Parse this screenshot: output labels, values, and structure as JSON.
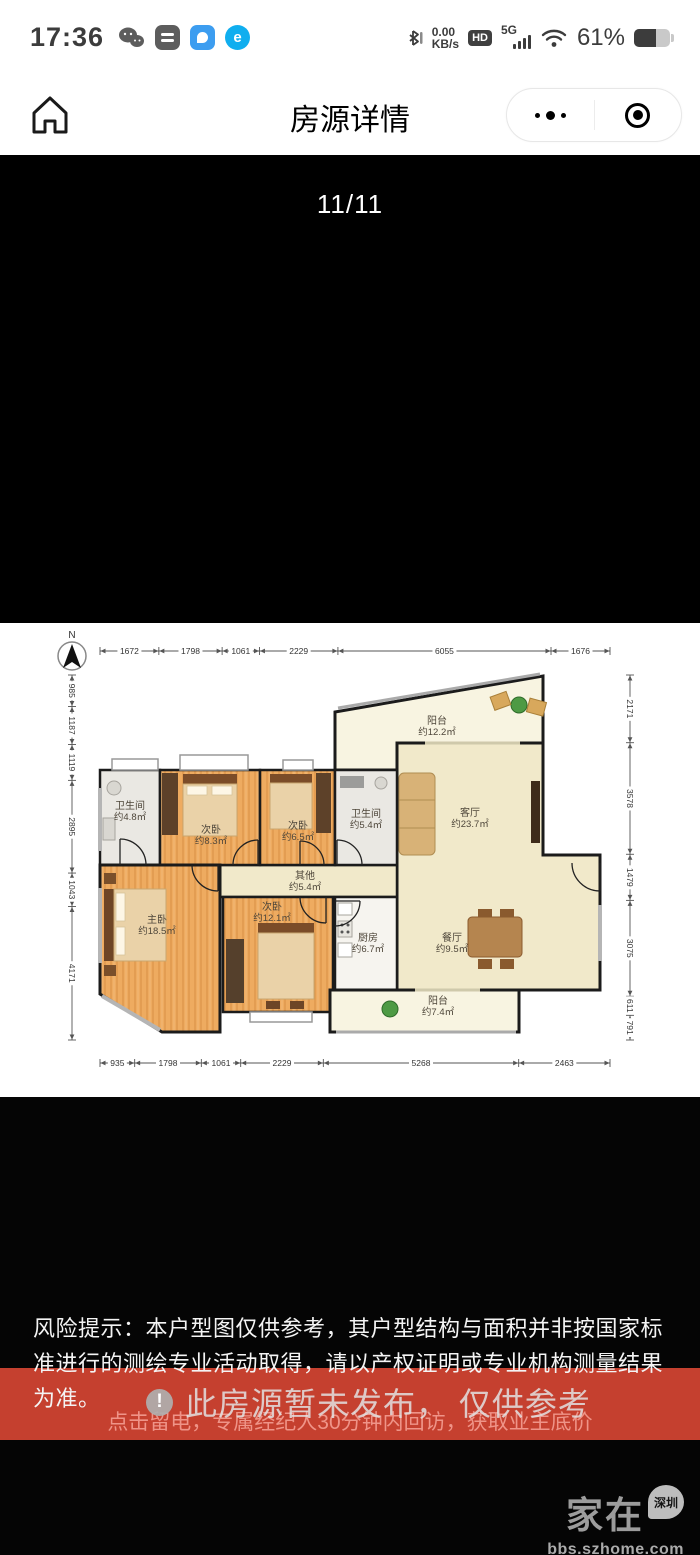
{
  "status_bar": {
    "time": "17:36",
    "speed_top": "0.00",
    "speed_bottom": "KB/s",
    "hd_label": "HD",
    "net_label": "5G",
    "battery_percent": "61%",
    "e_icon_label": "e"
  },
  "nav": {
    "title": "房源详情"
  },
  "gallery": {
    "counter": "11/11"
  },
  "floorplan": {
    "compass_label": "N",
    "dims": {
      "top": [
        1672,
        1798,
        1061,
        2229,
        6055,
        1676
      ],
      "bottom": [
        935,
        1798,
        1061,
        2229,
        5268,
        2463
      ],
      "left": [
        985,
        1187,
        1119,
        2895,
        1043,
        4171
      ],
      "right": [
        2171,
        3578,
        1479,
        3075,
        611,
        791
      ]
    },
    "rooms": {
      "balcony_top": {
        "name": "阳台",
        "area": "约12.2㎡"
      },
      "bath_48": {
        "name": "卫生间",
        "area": "约4.8㎡"
      },
      "bed_83": {
        "name": "次卧",
        "area": "约8.3㎡"
      },
      "bed_65": {
        "name": "次卧",
        "area": "约6.5㎡"
      },
      "bath_54": {
        "name": "卫生间",
        "area": "约5.4㎡"
      },
      "other": {
        "name": "其他",
        "area": "约5.4㎡"
      },
      "living": {
        "name": "客厅",
        "area": "约23.7㎡"
      },
      "master": {
        "name": "主卧",
        "area": "约18.5㎡"
      },
      "bed_121": {
        "name": "次卧",
        "area": "约12.1㎡"
      },
      "kitchen": {
        "name": "厨房",
        "area": "约6.7㎡"
      },
      "dining": {
        "name": "餐厅",
        "area": "约9.5㎡"
      },
      "balcony_bottom": {
        "name": "阳台",
        "area": "约7.4㎡"
      }
    }
  },
  "disclaimer": "风险提示：本户型图仅供参考，其户型结构与面积并非按国家标准进行的测绘专业活动取得，请以产权证明或专业机构测量结果为准。",
  "notice_overlay": "此房源暂未发布， 仅供参考",
  "cta": "点击留电，专属经纪人30分钟内回访，获取业主底价",
  "watermark": {
    "brand": "家在",
    "badge": "深圳",
    "site": "bbs.szhome.com"
  },
  "colors": {
    "banner_red": "#c5402f",
    "cta_text": "#ef9488"
  }
}
